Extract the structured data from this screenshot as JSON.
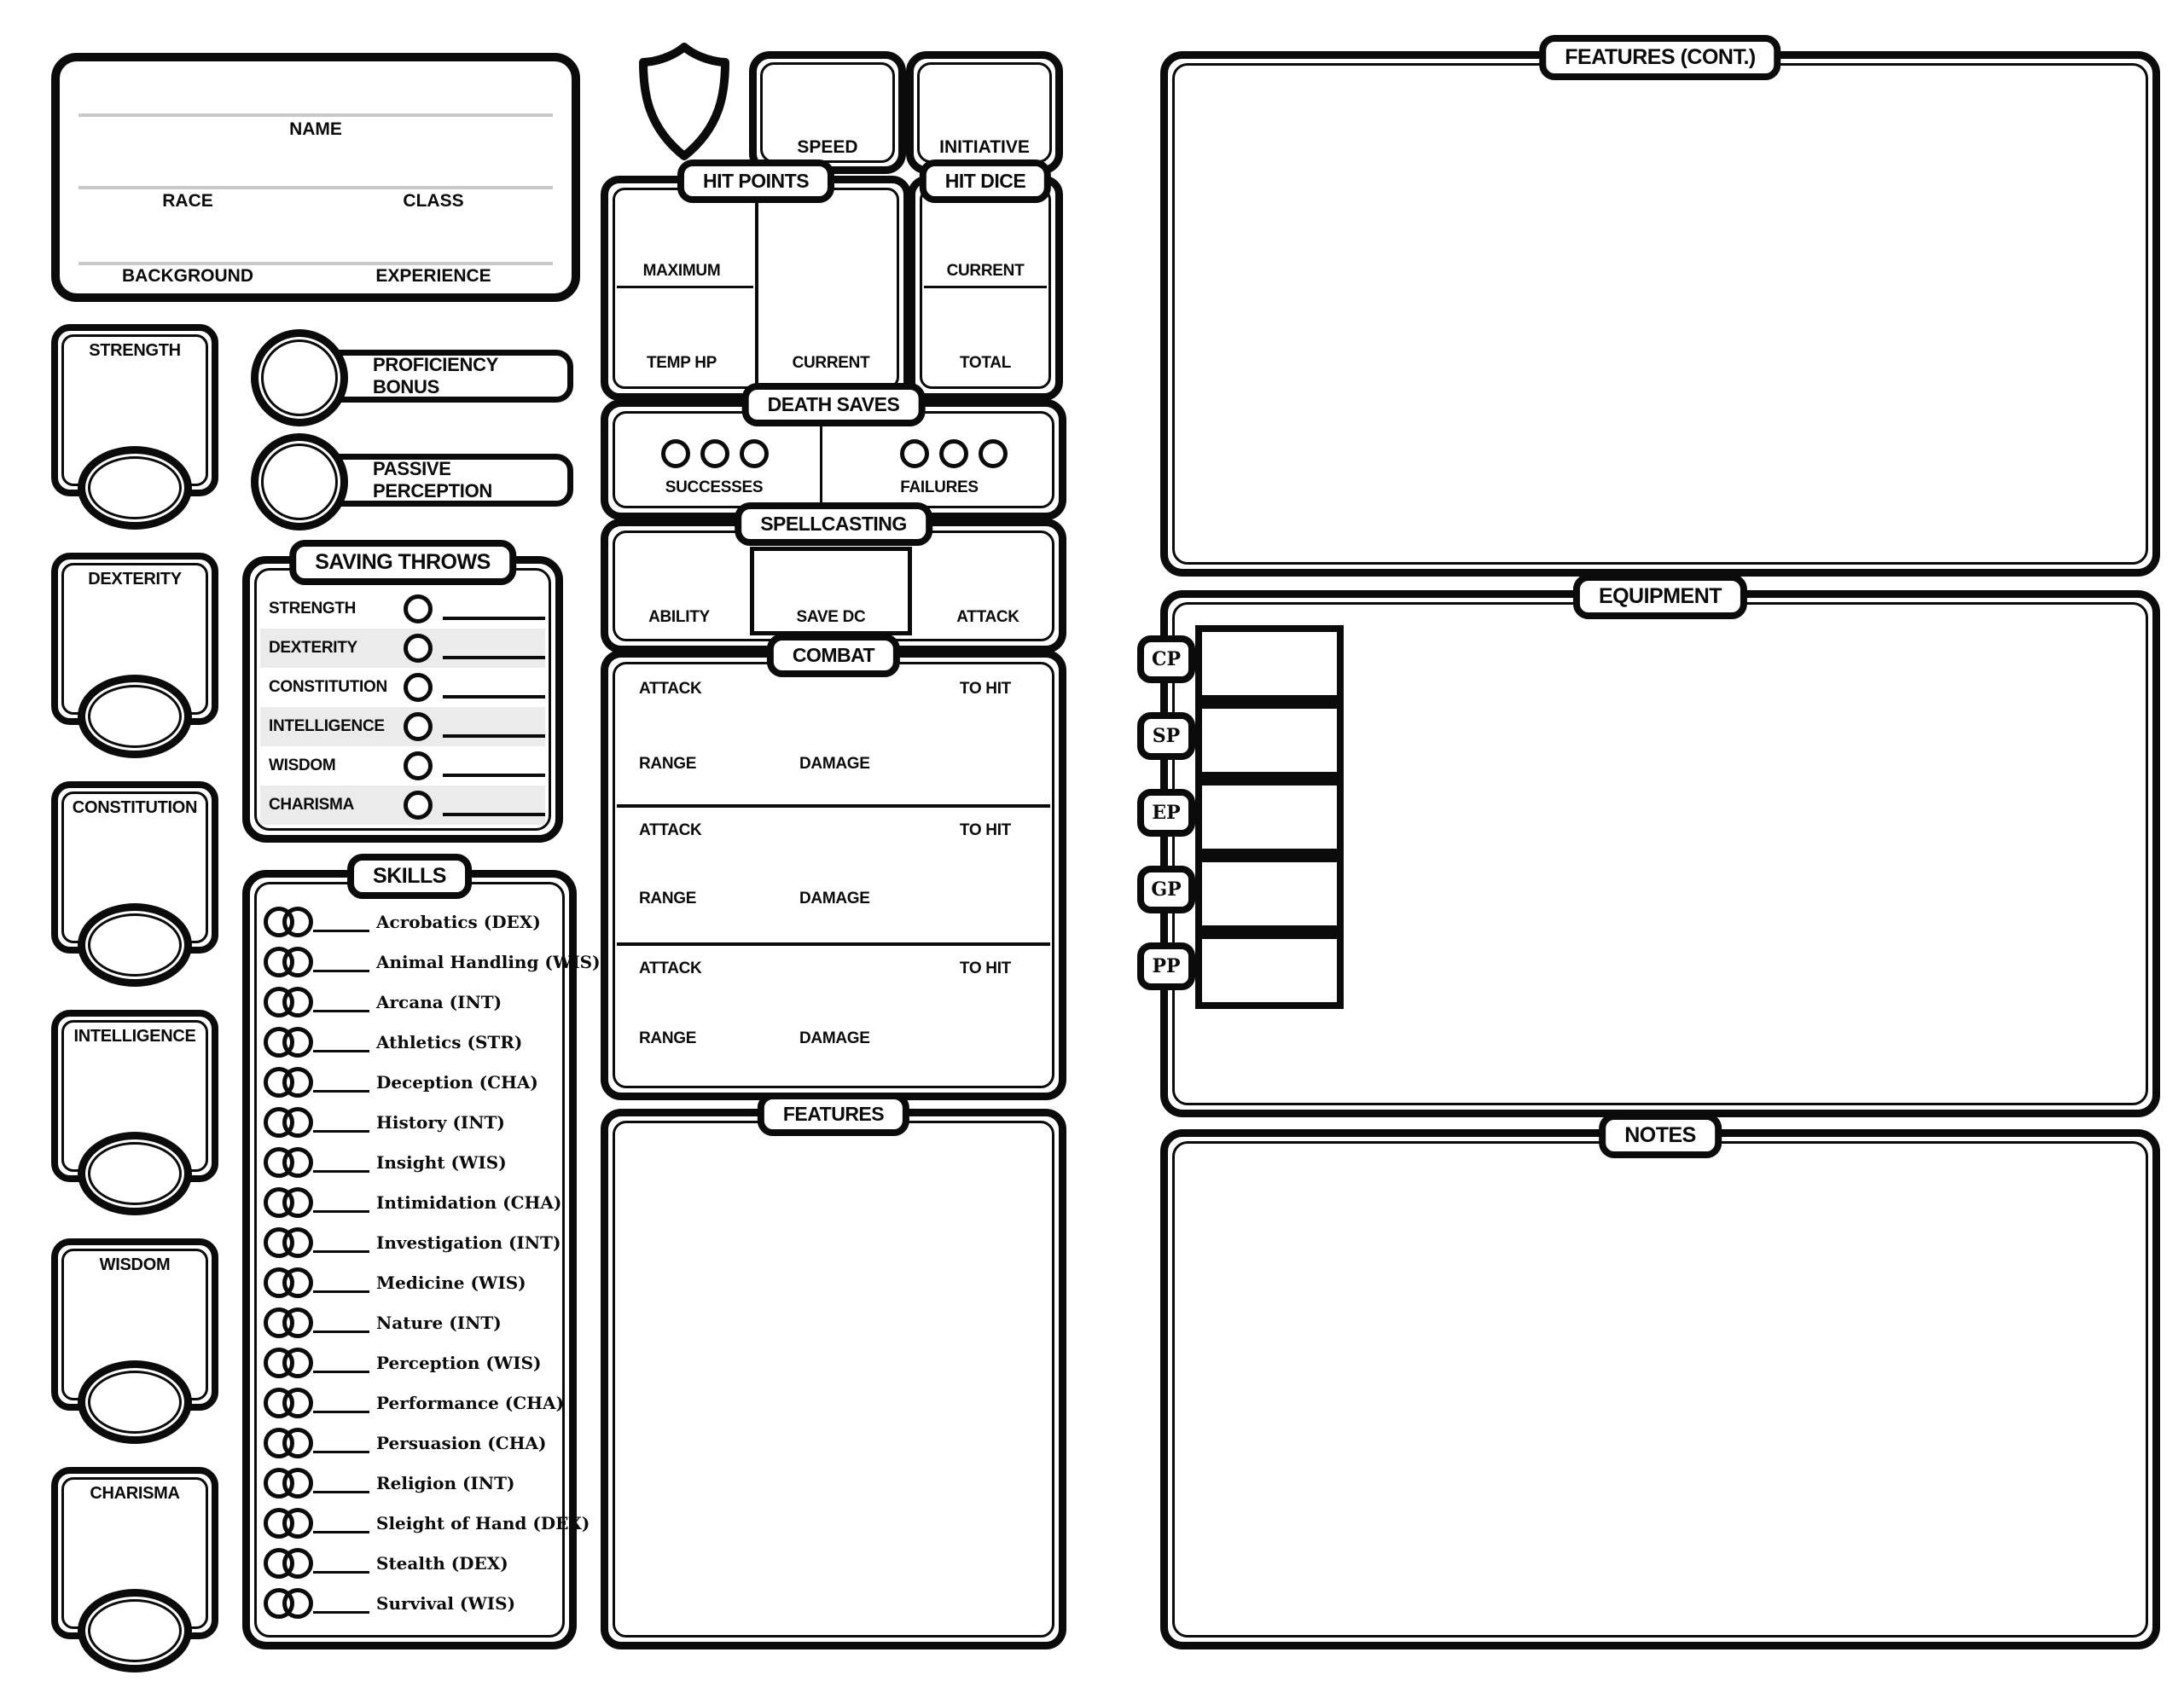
{
  "colors": {
    "ink": "#0b0b0b",
    "stripe": "#ebebeb",
    "rule": "#c9c9c9"
  },
  "header": {
    "name": "NAME",
    "race": "RACE",
    "class": "CLASS",
    "background": "BACKGROUND",
    "experience": "EXPERIENCE"
  },
  "abilities": [
    {
      "label": "STRENGTH"
    },
    {
      "label": "DEXTERITY"
    },
    {
      "label": "CONSTITUTION"
    },
    {
      "label": "INTELLIGENCE"
    },
    {
      "label": "WISDOM"
    },
    {
      "label": "CHARISMA"
    }
  ],
  "stats": {
    "proficiency_bonus": "PROFICIENCY BONUS",
    "passive_perception": "PASSIVE PERCEPTION"
  },
  "saving_throws": {
    "title": "SAVING THROWS",
    "rows": [
      "STRENGTH",
      "DEXTERITY",
      "CONSTITUTION",
      "INTELLIGENCE",
      "WISDOM",
      "CHARISMA"
    ]
  },
  "skills": {
    "title": "SKILLS",
    "items": [
      "Acrobatics (DEX)",
      "Animal Handling (WIS)",
      "Arcana (INT)",
      "Athletics (STR)",
      "Deception (CHA)",
      "History (INT)",
      "Insight (WIS)",
      "Intimidation (CHA)",
      "Investigation (INT)",
      "Medicine (WIS)",
      "Nature (INT)",
      "Perception (WIS)",
      "Performance (CHA)",
      "Persuasion (CHA)",
      "Religion (INT)",
      "Sleight of Hand (DEX)",
      "Stealth (DEX)",
      "Survival (WIS)"
    ]
  },
  "top_stats": {
    "speed": "SPEED",
    "initiative": "INITIATIVE"
  },
  "hit_points": {
    "title": "HIT POINTS",
    "maximum": "MAXIMUM",
    "temp_hp": "TEMP HP",
    "current": "CURRENT"
  },
  "hit_dice": {
    "title": "HIT DICE",
    "current": "CURRENT",
    "total": "TOTAL"
  },
  "death_saves": {
    "title": "DEATH SAVES",
    "successes": "SUCCESSES",
    "failures": "FAILURES"
  },
  "spellcasting": {
    "title": "SPELLCASTING",
    "ability": "ABILITY",
    "save_dc": "SAVE DC",
    "attack": "ATTACK"
  },
  "combat": {
    "title": "COMBAT",
    "attack": "ATTACK",
    "to_hit": "TO HIT",
    "range": "RANGE",
    "damage": "DAMAGE"
  },
  "features": {
    "title": "FEATURES"
  },
  "features_cont": {
    "title": "FEATURES (CONT.)"
  },
  "equipment": {
    "title": "EQUIPMENT",
    "currencies": [
      "CP",
      "SP",
      "EP",
      "GP",
      "PP"
    ]
  },
  "notes": {
    "title": "NOTES"
  }
}
